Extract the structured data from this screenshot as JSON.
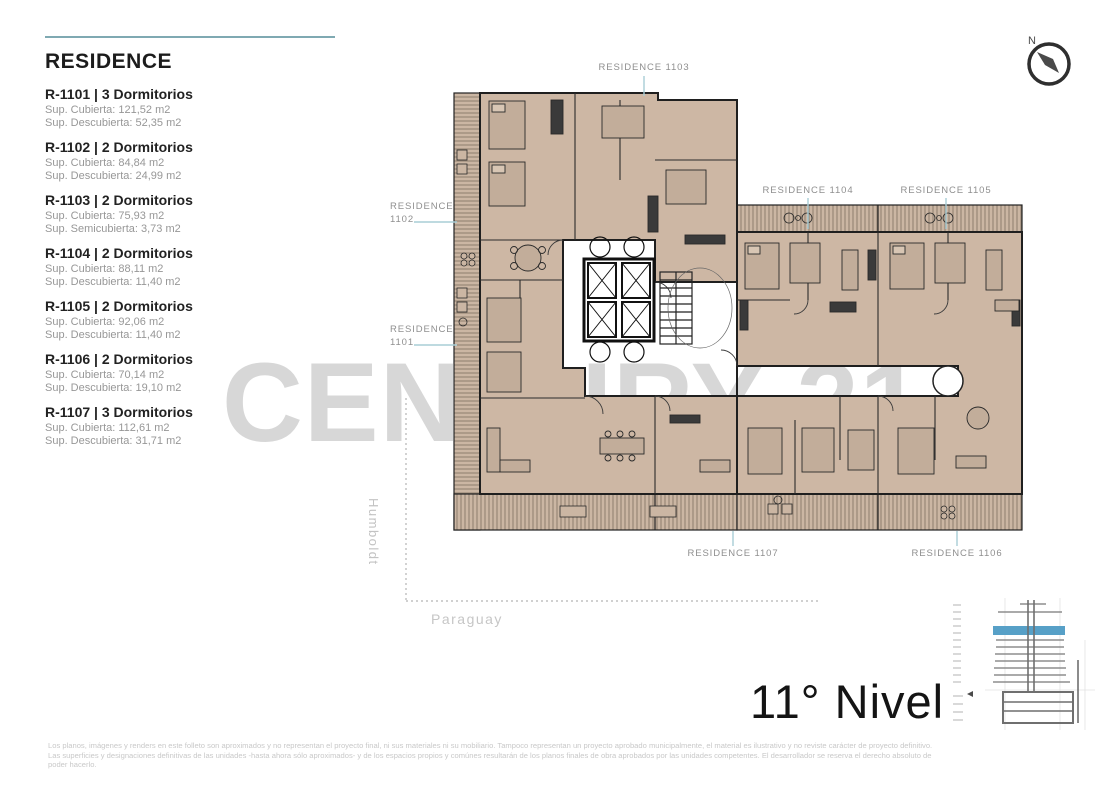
{
  "sidebar": {
    "title": "RESIDENCE",
    "residences": [
      {
        "title": "R-1101 | 3 Dormitorios",
        "line1": "Sup. Cubierta: 121,52 m2",
        "line2": "Sup. Descubierta: 52,35 m2"
      },
      {
        "title": "R-1102 | 2 Dormitorios",
        "line1": "Sup. Cubierta: 84,84 m2",
        "line2": "Sup. Descubierta: 24,99 m2"
      },
      {
        "title": "R-1103 | 2 Dormitorios",
        "line1": "Sup. Cubierta: 75,93 m2",
        "line2": "Sup. Semicubierta: 3,73 m2"
      },
      {
        "title": "R-1104 | 2 Dormitorios",
        "line1": "Sup. Cubierta: 88,11 m2",
        "line2": "Sup. Descubierta: 11,40 m2"
      },
      {
        "title": "R-1105 | 2 Dormitorios",
        "line1": "Sup. Cubierta: 92,06 m2",
        "line2": "Sup. Descubierta: 11,40 m2"
      },
      {
        "title": "R-1106 | 2 Dormitorios",
        "line1": "Sup. Cubierta: 70,14 m2",
        "line2": "Sup. Descubierta: 19,10 m2"
      },
      {
        "title": "R-1107 | 3 Dormitorios",
        "line1": "Sup. Cubierta: 112,61 m2",
        "line2": "Sup. Descubierta: 31,71 m2"
      }
    ]
  },
  "plan": {
    "labels": {
      "r1103": "RESIDENCE 1103",
      "r1104": "RESIDENCE 1104",
      "r1105": "RESIDENCE 1105",
      "r1102_l1": "RESIDENCE",
      "r1102_l2": "1102",
      "r1101_l1": "RESIDENCE",
      "r1101_l2": "1101",
      "r1107": "RESIDENCE 1107",
      "r1106": "RESIDENCE 1106"
    },
    "streets": {
      "vertical": "Humboldt",
      "horizontal": "Paraguay"
    }
  },
  "compass": {
    "north_label": "N"
  },
  "watermark": "CENTURY 21",
  "level": {
    "title": "11° Nivel"
  },
  "footer": {
    "lines": [
      "Los planos, imágenes y renders en este folleto son aproximados y no representan el proyecto final, ni sus materiales ni su mobiliario. Tampoco representan un proyecto aprobado municipalmente, el material es ilustrativo y no reviste carácter de proyecto definitivo.",
      "Las superficies y designaciones definitivas de las unidades -hasta ahora sólo aproximados- y de los espacios propios y comúnes resultarán de los planos finales de obra aprobados por las unidades competentes. El desarrollador se reserva el derecho absoluto de",
      "poder hacerlo."
    ]
  },
  "colors": {
    "accent_teal": "#7fa9b2",
    "leader_teal": "#a9ced6",
    "plan_beige": "#cdb7a4",
    "wall_dark": "#1f1f1f",
    "watermark_gray": "#d7d7d7",
    "level_highlight_blue": "#57a0c7"
  }
}
